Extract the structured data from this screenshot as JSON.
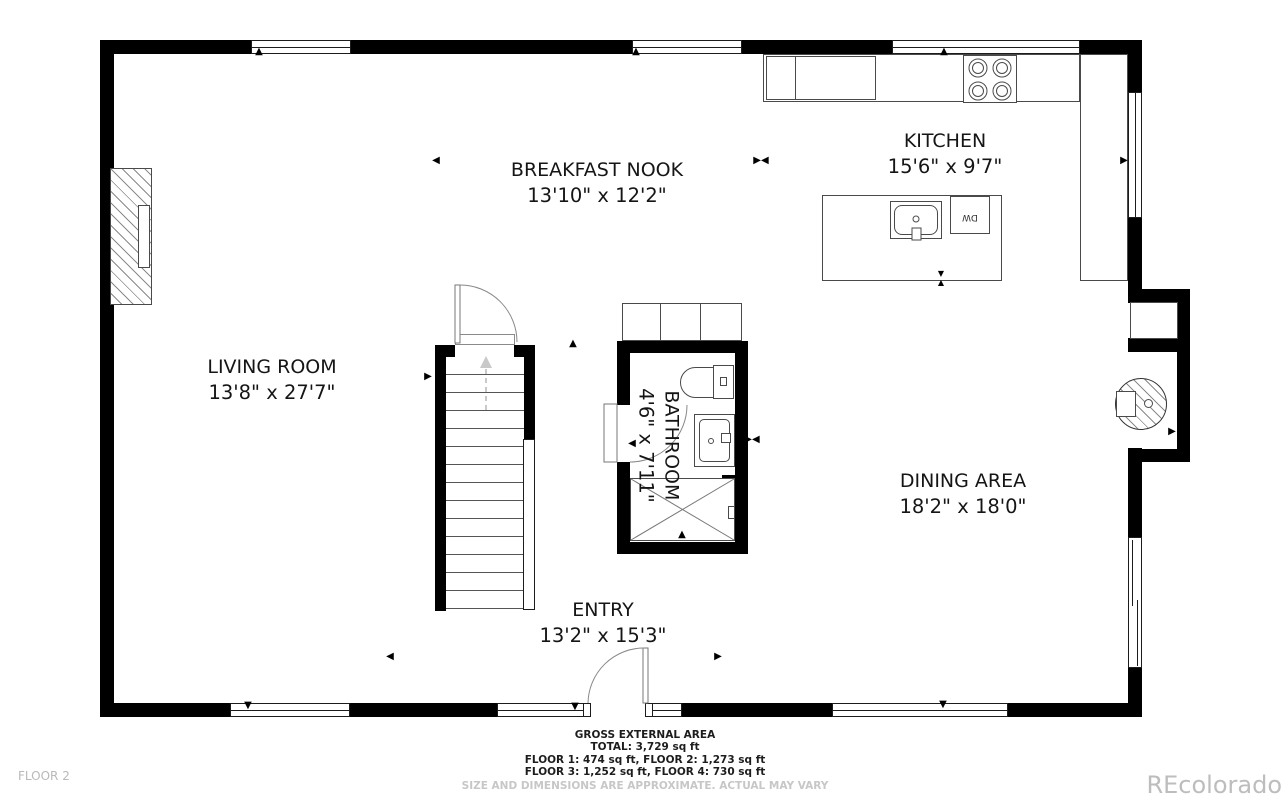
{
  "plan": {
    "rooms": [
      {
        "name": "BREAKFAST NOOK",
        "dims": "13'10\" x 12'2\""
      },
      {
        "name": "KITCHEN",
        "dims": "15'6\" x 9'7\""
      },
      {
        "name": "LIVING ROOM",
        "dims": "13'8\" x 27'7\""
      },
      {
        "name": "DINING AREA",
        "dims": "18'2\" x 18'0\""
      },
      {
        "name": "ENTRY",
        "dims": "13'2\" x 15'3\""
      },
      {
        "name": "BATHROOM",
        "dims": "4'6\" x 7'11\""
      }
    ],
    "fixtures": {
      "dishwasher": "DW"
    },
    "markers": {
      "up": "▲",
      "down": "▼",
      "left": "◀",
      "right": "▶",
      "pair": "▶◀"
    }
  },
  "footer": {
    "title": "GROSS EXTERNAL AREA",
    "total": "TOTAL: 3,729 sq ft",
    "floors_12": "FLOOR 1: 474 sq ft, FLOOR 2: 1,273 sq ft",
    "floors_34": "FLOOR 3: 1,252 sq ft, FLOOR 4: 730 sq ft",
    "disclaimer": "SIZE AND DIMENSIONS ARE APPROXIMATE. ACTUAL MAY VARY"
  },
  "page": {
    "floor_label": "FLOOR 2",
    "watermark": "REcolorado"
  },
  "colors": {
    "wall": "#000000",
    "label": "#151515",
    "muted": "#bdbdbd"
  }
}
